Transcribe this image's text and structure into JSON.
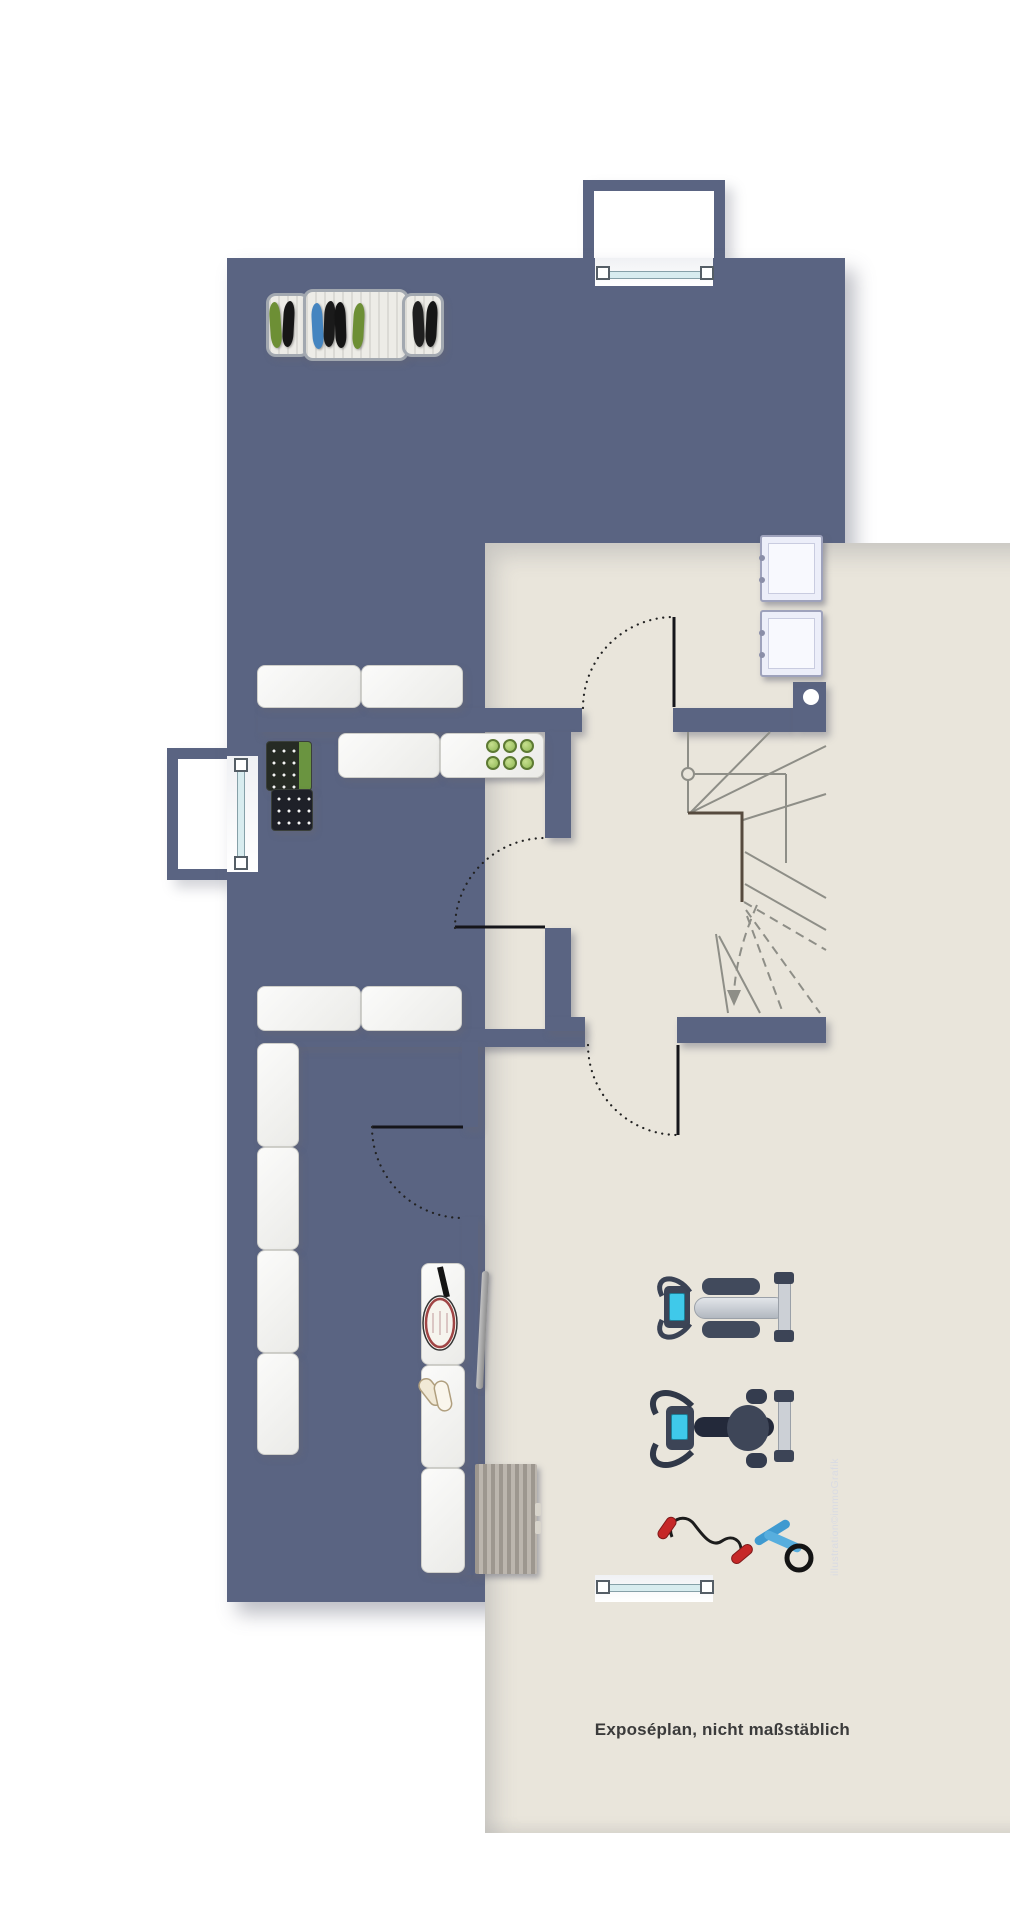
{
  "page": {
    "width": 1010,
    "height": 1920,
    "background": "#ffffff"
  },
  "caption": {
    "text": "Exposéplan, nicht maßstäblich"
  },
  "watermark": {
    "text": "illustration©immoGrafik"
  },
  "palette": {
    "wall": "#5a6482",
    "floor": "#e9e5db",
    "outside": "#ffffff",
    "door_glass": "#d8ecef",
    "stair_line": "#8e8e87",
    "stair_corner_edge": "#564a3e",
    "shelf_white": "#f6f6f4",
    "crate_dark": "#22261f",
    "crate_green": "#6a9440",
    "jar_green": "#a5c96a",
    "screen_cyan": "#3fc9ea",
    "band_handle_red": "#c62828",
    "rope_blue": "#3f9ad0",
    "shoe_green": "#6d8f35",
    "shoe_blue": "#4585c0"
  },
  "floorplan": {
    "kind": "basement-floor-plan",
    "openings": [
      {
        "name": "entry-light-well-top",
        "type": "exterior-door"
      },
      {
        "name": "window-left",
        "type": "window-with-light-well"
      },
      {
        "name": "exit-light-well-bottom",
        "type": "exterior-door"
      },
      {
        "name": "interior-doors",
        "count": 4
      }
    ],
    "rooms": [
      {
        "name": "storage-room-top",
        "furniture": [
          "shoe-rack",
          "washing-machine",
          "dryer",
          "floor-drain-dot"
        ]
      },
      {
        "name": "cellar-room-middle",
        "furniture": [
          "wall-shelf-row-top",
          "wall-shelf-row-inner",
          "preserving-jars",
          "bottle-crates",
          "wall-shelf-row-bottom"
        ]
      },
      {
        "name": "stair-hall",
        "furniture": [
          "winder-staircase",
          "handrail",
          "direction-arrow-down"
        ]
      },
      {
        "name": "storage-room-bottom-left",
        "furniture": [
          "shelf-column"
        ]
      },
      {
        "name": "fitness-room",
        "furniture": [
          "storage-bench-column",
          "tennis-racket",
          "sport-shoes",
          "leaning-bar",
          "gym-mat",
          "rowing-machine",
          "exercise-bike",
          "resistance-band",
          "skipping-rope"
        ]
      }
    ]
  }
}
